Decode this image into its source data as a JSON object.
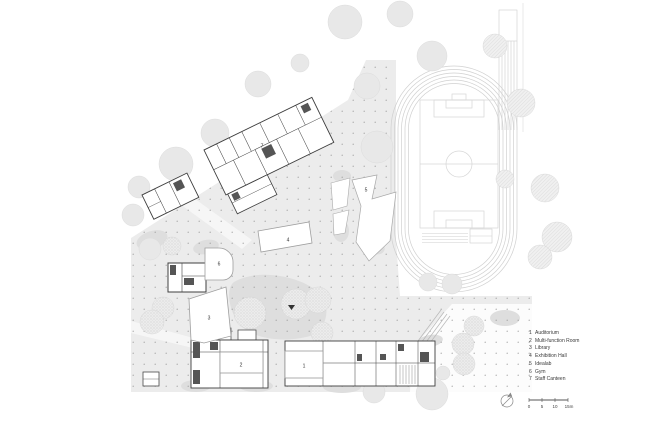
{
  "legend": {
    "items": [
      {
        "num": "1",
        "label": "Auditorium"
      },
      {
        "num": "2",
        "label": "Multi-function Room"
      },
      {
        "num": "3",
        "label": "Library"
      },
      {
        "num": "4",
        "label": "Exhibition Hall"
      },
      {
        "num": "5",
        "label": "Idealab"
      },
      {
        "num": "6",
        "label": "Gym"
      },
      {
        "num": "7",
        "label": "Staff Canteen"
      }
    ]
  },
  "scale_bar": {
    "ticks": [
      "0",
      "5",
      "10",
      "15m"
    ]
  },
  "plan": {
    "numbers": {
      "n1": "1",
      "n2": "2",
      "n3": "3",
      "n4": "4",
      "n5": "5",
      "n6": "6",
      "n7": "7"
    }
  },
  "colors": {
    "plaza": "#ececec",
    "planting_patch": "#dedede",
    "tree": "#e8e8e8",
    "building_line": "#3d3d3d",
    "track_line": "#d0d0d0"
  }
}
